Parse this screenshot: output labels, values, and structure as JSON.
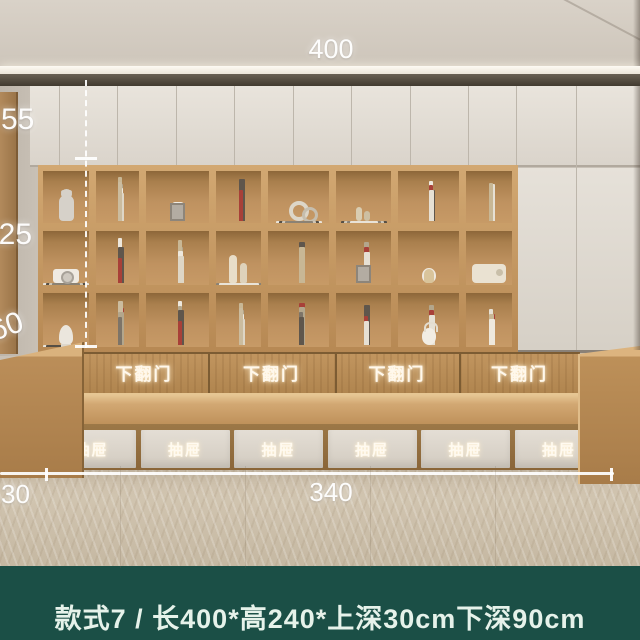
{
  "caption": {
    "text": "款式7 / 长400*高240*上深30cm下深90cm"
  },
  "dims": {
    "top_width": "400",
    "left_heights": [
      "55",
      "125",
      "60"
    ],
    "bottom_left_depth": "30",
    "bottom_bench_width": "340"
  },
  "bench": {
    "flip_doors": [
      "下翻门",
      "下翻门",
      "下翻门",
      "下翻门"
    ],
    "drawers": [
      "抽屉",
      "抽屉",
      "抽屉",
      "抽屉",
      "抽屉",
      "抽屉"
    ]
  },
  "colors": {
    "caption_band_green": "#1b4f46",
    "caption_text": "#e6f2ea",
    "wood_light": "#d2a872",
    "wood_mid": "#b98c58",
    "wood_dark": "#8d6739",
    "cabinet_white": "#e6e1d9",
    "wall_beige": "#cdc5ba",
    "carpet": "#ccc0ab",
    "dimension_text": "#ffffff"
  },
  "shelf": {
    "cells": [
      {
        "parts": [
          "bear-dark",
          "bear"
        ]
      },
      {
        "parts": [
          "books:9"
        ]
      },
      {
        "parts": [
          "robot",
          "frame"
        ]
      },
      {
        "parts": [
          "books:7"
        ]
      },
      {
        "parts": [
          "rings",
          "stack"
        ]
      },
      {
        "parts": [
          "stack",
          "bottles"
        ]
      },
      {
        "parts": [
          "books:8"
        ]
      },
      {
        "parts": [
          "books:6"
        ]
      },
      {
        "parts": [
          "stack",
          "camera"
        ]
      },
      {
        "parts": [
          "books:7"
        ]
      },
      {
        "parts": [
          "books:8"
        ]
      },
      {
        "parts": [
          "vases",
          "stack-sm"
        ]
      },
      {
        "parts": [
          "books:9"
        ]
      },
      {
        "parts": [
          "books:5",
          "frame"
        ]
      },
      {
        "parts": [
          "sphere",
          "cat"
        ]
      },
      {
        "parts": [
          "radio"
        ]
      },
      {
        "parts": [
          "stack-sm",
          "bust"
        ]
      },
      {
        "parts": [
          "books:8"
        ]
      },
      {
        "parts": [
          "books:7"
        ]
      },
      {
        "parts": [
          "books:9"
        ]
      },
      {
        "parts": [
          "books:9"
        ]
      },
      {
        "parts": [
          "books:8"
        ]
      },
      {
        "parts": [
          "books:5",
          "lantern"
        ]
      },
      {
        "parts": [
          "books:4"
        ]
      }
    ]
  }
}
